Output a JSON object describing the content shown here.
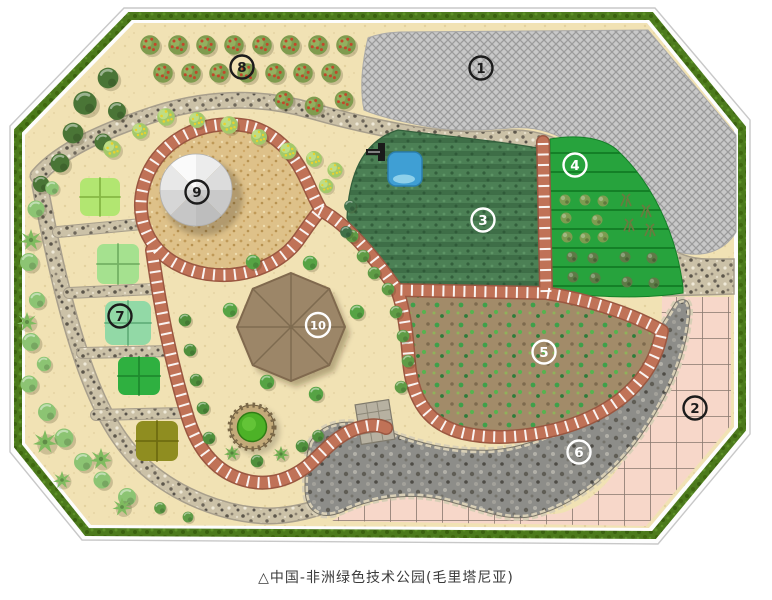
{
  "caption": {
    "text": "△中国-非洲绿色技术公园(毛里塔尼亚)"
  },
  "zones": [
    {
      "label": "1",
      "tone": "dark"
    },
    {
      "label": "2",
      "tone": "dark"
    },
    {
      "label": "3",
      "tone": "light"
    },
    {
      "label": "4",
      "tone": "light"
    },
    {
      "label": "5",
      "tone": "light"
    },
    {
      "label": "6",
      "tone": "light"
    },
    {
      "label": "7",
      "tone": "dark"
    },
    {
      "label": "8",
      "tone": "dark"
    },
    {
      "label": "9",
      "tone": "dark"
    },
    {
      "label": "10",
      "tone": "light"
    }
  ],
  "palette": {
    "sand_base": "#f1e2b4",
    "hedge_green": "#4c7a1c",
    "brick_path_red": "#c07257",
    "gravel_path": "#cbc1a7",
    "crop_field_dark_green": "#4c8055",
    "crop_field_bright_green": "#27a33d",
    "scrub_brown": "#a28b69",
    "rubble_grey": "#8d8d89",
    "paving_pink": "#f7d7c9",
    "hatch_grey": "#c8c8c8",
    "water_blue": "#3f9fd4",
    "dome_grey": "#d9d9d9",
    "pavilion_brown": "#9c8668"
  }
}
